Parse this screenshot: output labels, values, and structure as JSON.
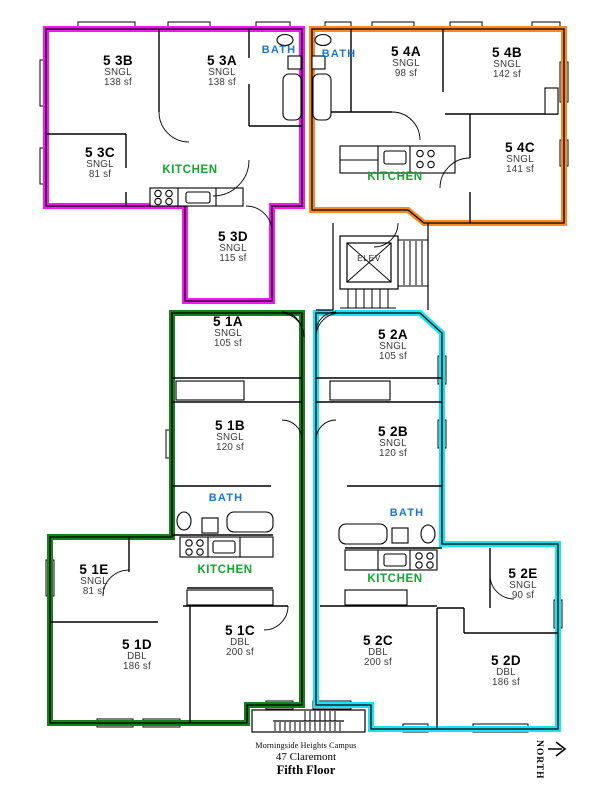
{
  "page": {
    "campus": "Morningside Heights Campus",
    "building": "47 Claremont",
    "floor": "Fifth Floor",
    "north_label": "NORTH"
  },
  "labels": {
    "kitchen": "KITCHEN",
    "bath": "BATH",
    "elevator": "ELEV"
  },
  "colors": {
    "suite1_green": "#177F1D",
    "suite2_cyan": "#19E2F2",
    "suite3_magenta": "#F318F3",
    "suite4_orange": "#F68A20",
    "kitchen_text": "#13A52F",
    "bath_text": "#1D74CE",
    "walls": "#000000"
  },
  "suites": [
    {
      "name": "Suite 5 1",
      "color": "#177F1D",
      "rooms": [
        "5 1A",
        "5 1B",
        "5 1C",
        "5 1D",
        "5 1E"
      ]
    },
    {
      "name": "Suite 5 2",
      "color": "#19E2F2",
      "rooms": [
        "5 2A",
        "5 2B",
        "5 2C",
        "5 2D",
        "5 2E"
      ]
    },
    {
      "name": "Suite 5 3",
      "color": "#F318F3",
      "rooms": [
        "5 3A",
        "5 3B",
        "5 3C",
        "5 3D"
      ]
    },
    {
      "name": "Suite 5 4",
      "color": "#F68A20",
      "rooms": [
        "5 4A",
        "5 4B",
        "5 4C"
      ]
    }
  ],
  "rooms": [
    {
      "name": "5 3B",
      "type": "SNGL",
      "area": "138 sf"
    },
    {
      "name": "5 3A",
      "type": "SNGL",
      "area": "138 sf"
    },
    {
      "name": "5 3C",
      "type": "SNGL",
      "area": "81 sf"
    },
    {
      "name": "5 3D",
      "type": "SNGL",
      "area": "115 sf"
    },
    {
      "name": "5 4A",
      "type": "SNGL",
      "area": "98 sf"
    },
    {
      "name": "5 4B",
      "type": "SNGL",
      "area": "142 sf"
    },
    {
      "name": "5 4C",
      "type": "SNGL",
      "area": "141 sf"
    },
    {
      "name": "5 1A",
      "type": "SNGL",
      "area": "105 sf"
    },
    {
      "name": "5 1B",
      "type": "SNGL",
      "area": "120 sf"
    },
    {
      "name": "5 1C",
      "type": "DBL",
      "area": "200 sf"
    },
    {
      "name": "5 1D",
      "type": "DBL",
      "area": "186 sf"
    },
    {
      "name": "5 1E",
      "type": "SNGL",
      "area": "81 sf"
    },
    {
      "name": "5 2A",
      "type": "SNGL",
      "area": "105 sf"
    },
    {
      "name": "5 2B",
      "type": "SNGL",
      "area": "120 sf"
    },
    {
      "name": "5 2C",
      "type": "DBL",
      "area": "200 sf"
    },
    {
      "name": "5 2D",
      "type": "DBL",
      "area": "186 sf"
    },
    {
      "name": "5 2E",
      "type": "SNGL",
      "area": "90 sf"
    }
  ]
}
